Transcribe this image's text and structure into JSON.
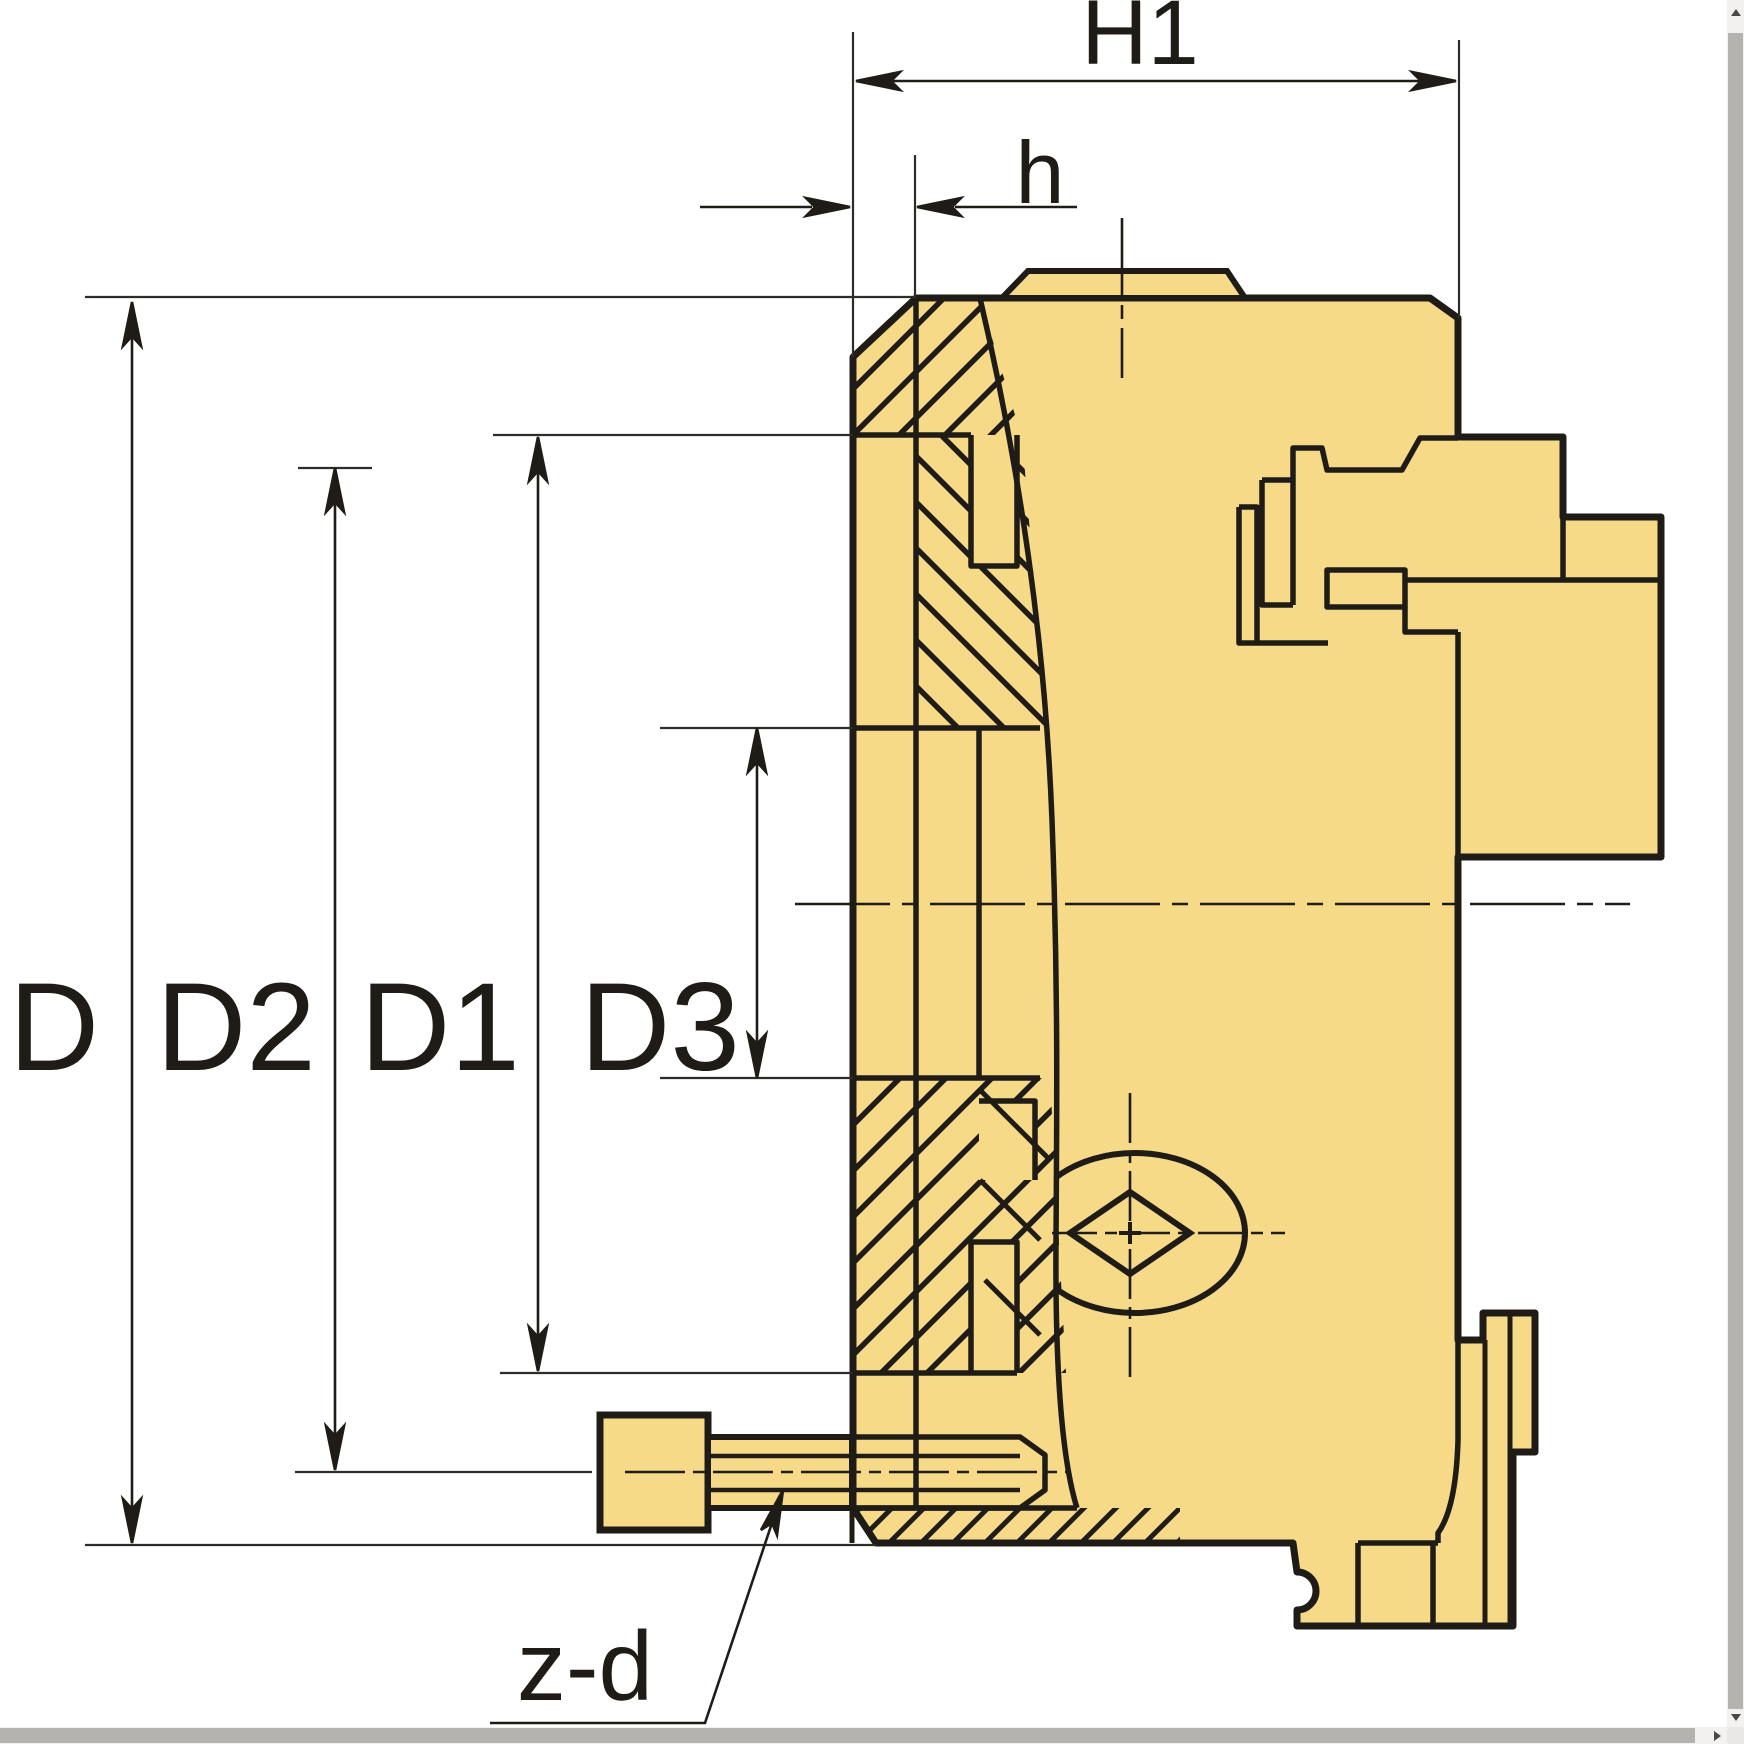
{
  "drawing": {
    "description": "lathe-chuck-cross-section",
    "labels": {
      "d": "D",
      "d2": "D2",
      "d1": "D1",
      "d3": "D3",
      "h1": "H1",
      "h": "h",
      "zd": "z-d"
    },
    "colors": {
      "part_fill": "#F6DA88",
      "line": "#1f1c17",
      "thin_line": "#2e2c29",
      "scrollbar_track": "#f2f1ef",
      "scrollbar_thumb": "#b5b3b0"
    }
  }
}
